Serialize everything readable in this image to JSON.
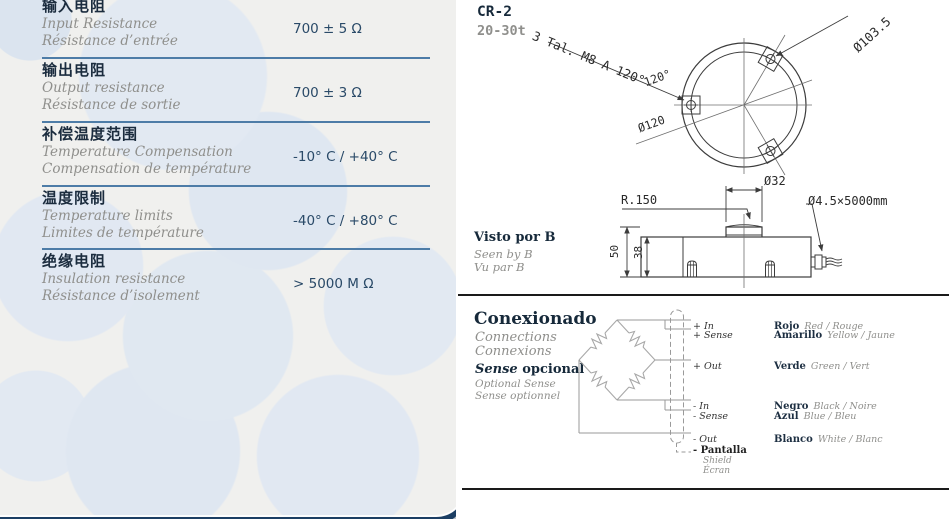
{
  "product": {
    "model": "CR-2",
    "capacity": "20-30t"
  },
  "specs": {
    "rows": [
      {
        "cn": "输入电阻",
        "en": "Input Resistance",
        "fr": "Résistance d’entrée",
        "value": "700 ± 5 Ω"
      },
      {
        "cn": "输出电阻",
        "en": "Output resistance",
        "fr": "Résistance de sortie",
        "value": "700 ± 3 Ω"
      },
      {
        "cn": "补偿温度范围",
        "en": "Temperature Compensation",
        "fr": "Compensation de température",
        "value": "-10° C / +40° C"
      },
      {
        "cn": "温度限制",
        "en": "Temperature limits",
        "fr": "Limites de température",
        "value": "-40° C / +80° C"
      },
      {
        "cn": "绝缘电阻",
        "en": "Insulation resistance",
        "fr": "Résistance d’isolement",
        "value": "> 5000 M Ω"
      }
    ]
  },
  "drawing": {
    "top_view": {
      "holes_note": "3 Tal. M8 A 120°",
      "bolt_circle": "Ø103.5",
      "angle": "120°",
      "diameter": "Ø120"
    },
    "side_view": {
      "sphere_radius": "R.150",
      "boss_diameter": "Ø32",
      "cable": "Ø4.5×5000mm",
      "total_height": "50",
      "body_height": "38"
    },
    "view_label": {
      "es": "Visto por B",
      "en": "Seen by B",
      "fr": "Vu par B"
    }
  },
  "connections": {
    "title_es": "Conexionado",
    "title_en": "Connections",
    "title_fr": "Connexions",
    "sense": {
      "word": "Sense",
      "rest": " opcional"
    },
    "sense_en": "Optional Sense",
    "sense_fr": "Sense optionnel",
    "wires": [
      {
        "signal": "+ In",
        "color": "Rojo",
        "trans": "Red / Rouge"
      },
      {
        "signal": "+ Sense",
        "color": "Amarillo",
        "trans": "Yellow / Jaune"
      },
      {
        "signal": "+ Out",
        "color": "Verde",
        "trans": "Green / Vert"
      },
      {
        "signal": "- In",
        "color": "Negro",
        "trans": "Black / Noire"
      },
      {
        "signal": "- Sense",
        "color": "Azul",
        "trans": "Blue / Bleu"
      },
      {
        "signal": "- Out",
        "color": "Blanco",
        "trans": "White / Blanc"
      }
    ],
    "shield": {
      "es": "- Pantalla",
      "en": "Shield",
      "fr": "Écran"
    }
  },
  "colors": {
    "card_border": "#1b3e63",
    "separator": "#4d7ca7",
    "card_bg": "#f0f0ee",
    "circle_tint": "#e0e8f1",
    "heading": "#16293a",
    "muted": "#8f8f8c",
    "value": "#2a4a68"
  }
}
